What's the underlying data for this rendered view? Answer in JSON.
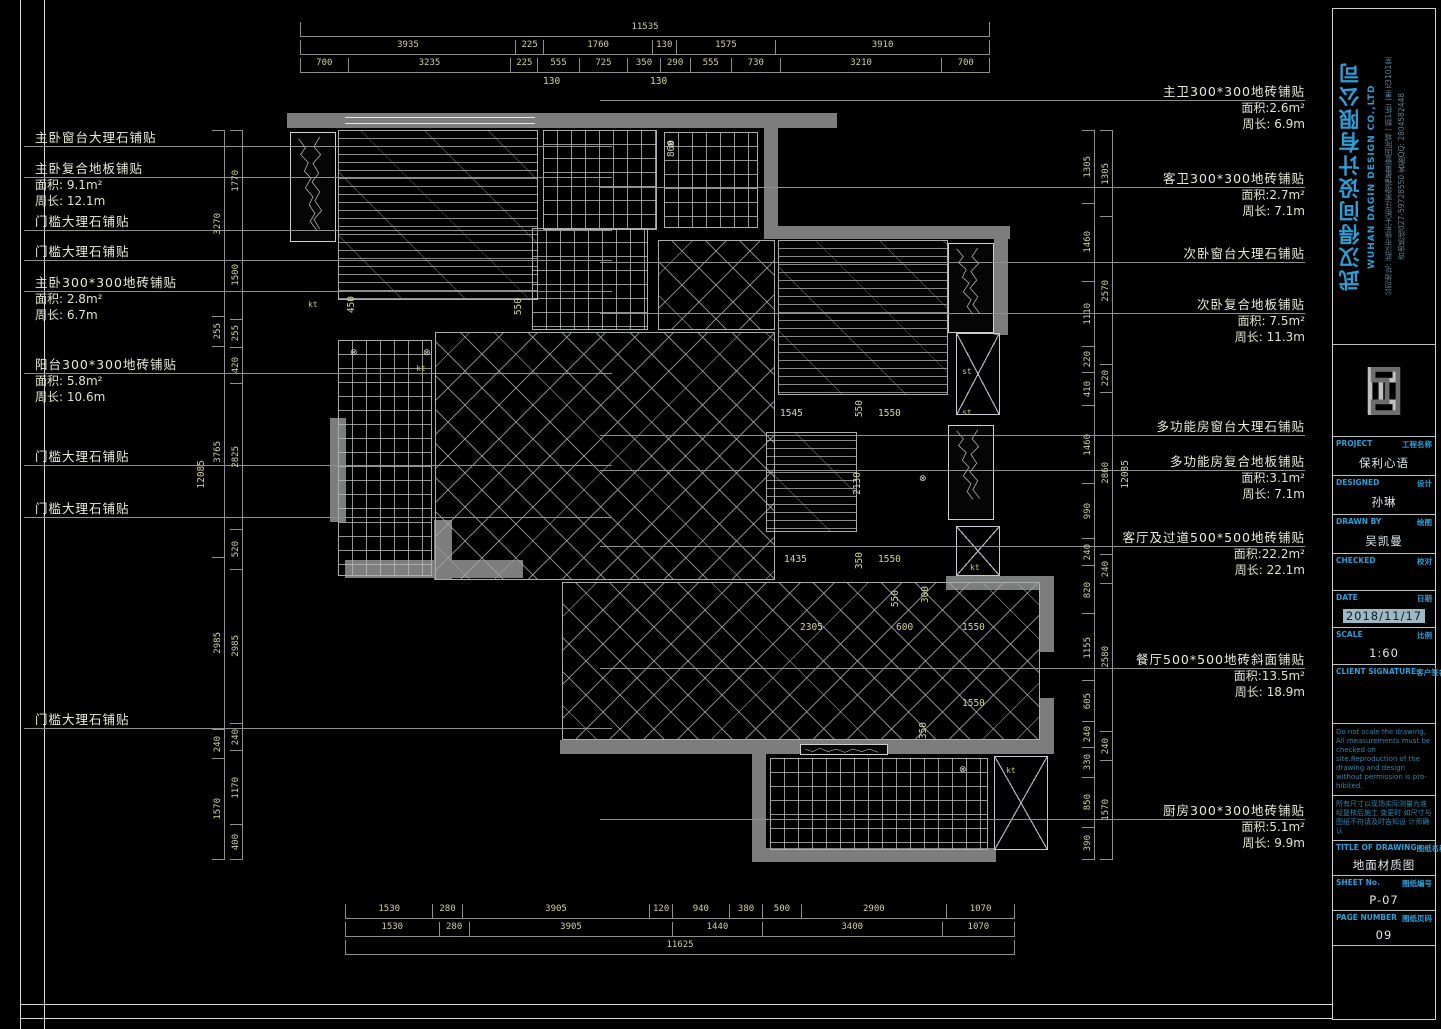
{
  "title_block": {
    "company_cn": "武汉得间设计有限公司",
    "company_en": "WUHAN DAGIN DESIGN CO.,LTD",
    "address": "公司地址: 武汉市徐东大街汪家墩福星惠誉国际城一期1栋二单元3101室",
    "hotline": "咨询热线027-59728550  客服QQ: 2804582448",
    "rows": [
      {
        "en": "PROJECT",
        "cn": "工程名称",
        "value": "保利心语",
        "vh": 26
      },
      {
        "en": "DESIGNED",
        "cn": "设计",
        "value": "孙琳",
        "vh": 26
      },
      {
        "en": "DRAWN BY",
        "cn": "绘图",
        "value": "吴凯曼",
        "vh": 26
      },
      {
        "en": "CHECKED",
        "cn": "校对",
        "value": "",
        "vh": 24
      },
      {
        "en": "DATE",
        "cn": "日期",
        "value": "2018/11/17",
        "vh": 24,
        "highlight": true
      },
      {
        "en": "SCALE",
        "cn": "比例",
        "value": "1:60",
        "vh": 24
      },
      {
        "en": "CLIENT SIGNATURE",
        "cn": "客户签名",
        "value": "",
        "vh": 46
      }
    ],
    "note_en": "Do not scale the drawing, All measurements must be checked on site.Reproduction of the drawing and design without permission is pro- hibited.",
    "note_cn": "所有尺寸以现场实际测量为准经复核后施工 变更时 如尺寸与图纸不符请及时告知设 计师确认",
    "drawing_rows": [
      {
        "en": "TITLE OF DRAWING",
        "cn": "图纸名称",
        "value": "地面材质图",
        "vh": 22
      },
      {
        "en": "SHEET No.",
        "cn": "图纸编号",
        "value": "P-07",
        "vh": 22
      },
      {
        "en": "PAGE NUMBER",
        "cn": "图纸页码",
        "value": "09",
        "vh": 22
      }
    ]
  },
  "annotations": {
    "left": [
      {
        "title": "主卧窗台大理石铺贴",
        "details": [],
        "y": 130
      },
      {
        "title": "主卧复合地板铺贴",
        "details": [
          "面积: 9.1m²",
          "周长: 12.1m"
        ],
        "y": 161
      },
      {
        "title": "门槛大理石铺贴",
        "details": [],
        "y": 214
      },
      {
        "title": "门槛大理石铺贴",
        "details": [],
        "y": 244
      },
      {
        "title": "主卧300*300地砖铺贴",
        "details": [
          "面积: 2.8m²",
          "周长:  6.7m"
        ],
        "y": 275
      },
      {
        "title": "阳台300*300地砖铺贴",
        "details": [
          "面积: 5.8m²",
          "周长: 10.6m"
        ],
        "y": 357
      },
      {
        "title": "门槛大理石铺贴",
        "details": [],
        "y": 449
      },
      {
        "title": "门槛大理石铺贴",
        "details": [],
        "y": 501
      },
      {
        "title": "门槛大理石铺贴",
        "details": [],
        "y": 712
      }
    ],
    "right": [
      {
        "title": "主卫300*300地砖铺贴",
        "details": [
          "面积:2.6m²",
          "周长: 6.9m"
        ],
        "y": 84
      },
      {
        "title": "客卫300*300地砖铺贴",
        "details": [
          "面积:2.7m²",
          "周长: 7.1m"
        ],
        "y": 171
      },
      {
        "title": "次卧窗台大理石铺贴",
        "details": [],
        "y": 246
      },
      {
        "title": "次卧复合地板铺贴",
        "details": [
          "面积: 7.5m²",
          "周长: 11.3m"
        ],
        "y": 297
      },
      {
        "title": "多功能房窗台大理石铺贴",
        "details": [],
        "y": 419
      },
      {
        "title": "多功能房复合地板铺贴",
        "details": [
          "面积:3.1m²",
          "周长: 7.1m"
        ],
        "y": 454
      },
      {
        "title": "客厅及过道500*500地砖铺贴",
        "details": [
          "面积:22.2m²",
          "周长: 22.1m"
        ],
        "y": 530
      },
      {
        "title": "餐厅500*500地砖斜面铺贴",
        "details": [
          "面积:13.5m²",
          "周长: 18.9m"
        ],
        "y": 652
      },
      {
        "title": "厨房300*300地砖铺贴",
        "details": [
          "面积:5.1m²",
          "周长: 9.9m"
        ],
        "y": 803
      }
    ]
  },
  "dimensions": {
    "top": {
      "overall": "11535",
      "row2": [
        "3935",
        "225",
        "1760",
        "130",
        "1575",
        "3910"
      ],
      "row3": [
        "700",
        "3235",
        "225",
        "555",
        "725",
        "350",
        "290",
        "555",
        "730",
        "3210",
        "700"
      ]
    },
    "bottom": {
      "row1": [
        "1530",
        "280",
        "3905",
        "120",
        "940",
        "380",
        "500",
        "2900",
        "1070"
      ],
      "row2": [
        "1530",
        "280",
        "3905",
        "1440",
        "3400",
        "1070"
      ],
      "overall": "11625"
    },
    "left": {
      "overall": "12085",
      "colA": [
        "3270",
        "255",
        "3765",
        "2985",
        "240",
        "1570"
      ],
      "colB": [
        "1770",
        "1500",
        "255",
        "420",
        "2825",
        "520",
        "2985",
        "240",
        "1170",
        "400"
      ]
    },
    "right": {
      "overall": "12085",
      "colC": [
        "1305",
        "1460",
        "1110",
        "220",
        "410",
        "1460",
        "990",
        "240",
        "820",
        "1155",
        "605",
        "240",
        "330",
        "850",
        "390"
      ],
      "colD": [
        "1305",
        "2570",
        "220",
        "2860",
        "240",
        "2580",
        "240",
        "1570"
      ]
    },
    "interior": [
      {
        "t": "450",
        "x": 346,
        "y": 296,
        "r": 1
      },
      {
        "t": "550",
        "x": 513,
        "y": 298,
        "r": 1
      },
      {
        "t": "860",
        "x": 666,
        "y": 140,
        "r": 1
      },
      {
        "t": "130",
        "x": 543,
        "y": 76
      },
      {
        "t": "130",
        "x": 650,
        "y": 76
      },
      {
        "t": "1545",
        "x": 780,
        "y": 408
      },
      {
        "t": "550",
        "x": 854,
        "y": 400,
        "r": 1
      },
      {
        "t": "1550",
        "x": 878,
        "y": 408
      },
      {
        "t": "2130",
        "x": 852,
        "y": 472,
        "r": 1
      },
      {
        "t": "1435",
        "x": 784,
        "y": 554
      },
      {
        "t": "350",
        "x": 854,
        "y": 552,
        "r": 1
      },
      {
        "t": "1550",
        "x": 878,
        "y": 554
      },
      {
        "t": "550",
        "x": 890,
        "y": 590,
        "r": 1
      },
      {
        "t": "300",
        "x": 920,
        "y": 586,
        "r": 1
      },
      {
        "t": "2305",
        "x": 800,
        "y": 622
      },
      {
        "t": "600",
        "x": 896,
        "y": 622
      },
      {
        "t": "1550",
        "x": 962,
        "y": 622
      },
      {
        "t": "1550",
        "x": 962,
        "y": 698
      },
      {
        "t": "350",
        "x": 918,
        "y": 722,
        "r": 1
      }
    ]
  },
  "plan": {
    "markers": [
      {
        "t": "kt",
        "x": 308,
        "y": 300
      },
      {
        "t": "kt",
        "x": 416,
        "y": 364
      },
      {
        "t": "st",
        "x": 962,
        "y": 367
      },
      {
        "t": "st",
        "x": 962,
        "y": 408
      },
      {
        "t": "kt",
        "x": 970,
        "y": 563
      },
      {
        "t": "kt",
        "x": 1006,
        "y": 766
      }
    ],
    "drains": [
      {
        "x": 350,
        "y": 349
      },
      {
        "x": 423,
        "y": 349
      },
      {
        "x": 667,
        "y": 141
      },
      {
        "x": 919,
        "y": 475
      },
      {
        "x": 959,
        "y": 766
      }
    ],
    "drain_glyph": "⊗"
  }
}
